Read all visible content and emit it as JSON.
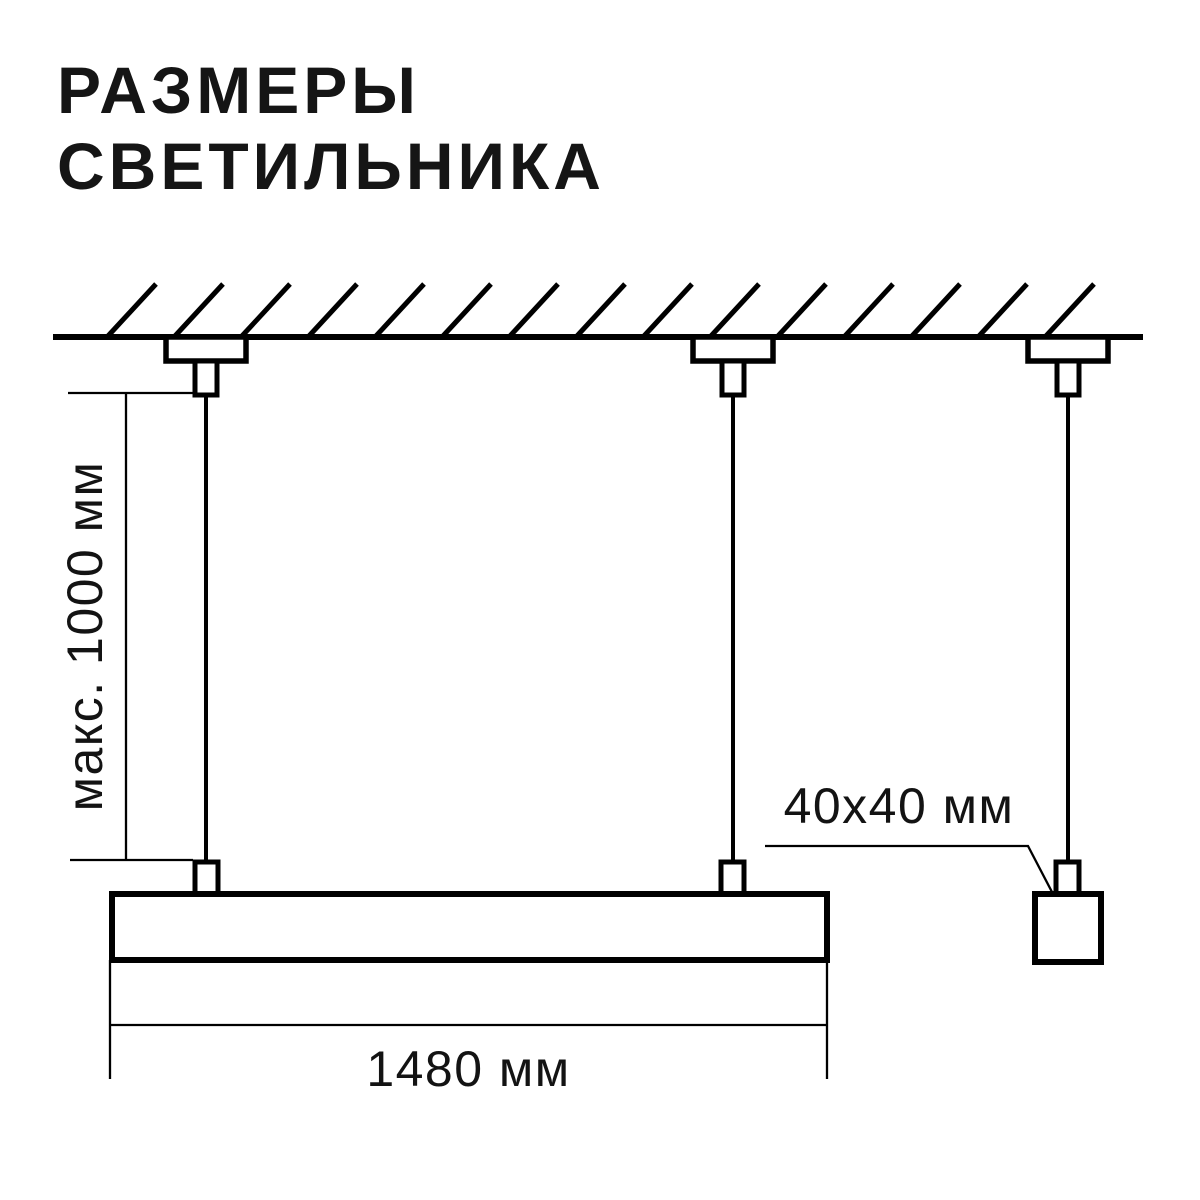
{
  "title": {
    "line1": "РАЗМЕРЫ",
    "line2": "СВЕТИЛЬНИКА"
  },
  "dimensions": {
    "max_suspension_height": "макс. 1000 мм",
    "luminaire_length": "1480 мм",
    "profile_cross_section": "40x40 мм"
  },
  "colors": {
    "ink": "#0d0d0d",
    "line": "#000000",
    "background": "#ffffff"
  },
  "diagram_parts": [
    "ceiling-hatching-icon",
    "ceiling-line",
    "ceiling-canopy-icon",
    "suspension-cable",
    "cable-gripper-icon",
    "luminaire-bar",
    "profile-cross-section-square",
    "dimension-line",
    "leader-line"
  ]
}
